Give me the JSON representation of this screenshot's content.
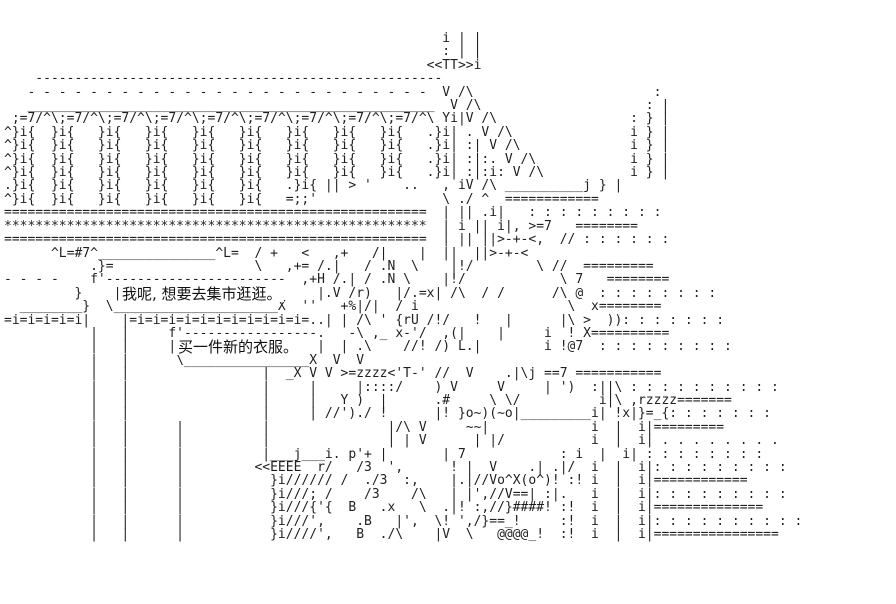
{
  "scene": {
    "background_color": "#ffffff",
    "ink_color": "#1f1f1f",
    "dialogue": {
      "line1": "我呢, 想要去集市逛逛。",
      "line2": "买一件新的衣服。"
    },
    "background_glyphs": [
      "《苶》i",
      "《竺竺",
      "宊宊",
      "雷雷"
    ],
    "art_lines": [
      "                                                        i | |",
      "                                                        : | |",
      "                                                      <<TT>>i",
      "    ----------------------------------------------------",
      "   - - - - - - - - - - - - - - - - - - - - - - - - - -  V /\\                       :",
      "   ____________________________________________________  V /\\                     : |",
      " ;=7/^\\;=7/^\\;=7/^\\;=7/^\\;=7/^\\;=7/^\\;=7/^\\;=7/^\\;=7/^\\ Yi|V /\\                 : } |",
      "^}i{  }i{   }i{   }i{   }i{   }i{   }i{   }i{   }i{   .}i| . V /\\               i } |",
      "^}i{  }i{   }i{   }i{   }i{   }i{   }i{   }i{   }i{   .}i| :| V /\\              i } |",
      "^}i{  }i{   }i{   }i{   }i{   }i{   }i{   }i{   }i{   .}i| :|:. V /\\            i } |",
      "^}i{  }i{   }i{   }i{   }i{   }i{   }i{   }i{   }i{   .}i| :|:i: V /\\           i } |",
      ".}i{  }i{   }i{   }i{   }i{   }i{   .}i{ || > '    ..   , iV /\\ __________j } |",
      "^}i{  }i{   }i{   }i{   }i{   }i{   =;;'                \\ ./ ^  ============",
      "======================================================  | || .i|   : : : : : : : : :",
      "******************************************************  | i || i|, >=7   ========",
      "======================================================  | || ||>-+-<,  // : : : : : :",
      "      ^L=#7^_______________^L=  / +   <   ,+   /|    |  ||  ||>-+-<",
      "           .}=                  \\   ,+= /.|   / .N  \\    |!/        \\ //  =========",
      "- - - -    f'-----------------------  ,+H /.| / .N \\    |!/            \\ 7   ========",
      "         }    |                         |.V /r)   |/.=x| /\\  / /      /\\ @  : : : : : : : :",
      "  ________}  \\_____________________X  ''   +%|/|  / i                   \\  x========",
      "=i=i=i=i=i|    |=i=i=i=i=i=i=i=i=i=i=i=..| | /\\ ' {rU /!/   !   |      |\\ >  )): : : : : : :",
      "           |   |     f'-----------------.   -\\ ,_ x-'/  ,(|    |     i  ! X==========",
      "           |   |     |                  |  | .\\    //! /) L.|        i !@7  : : : : : : : : :",
      "           |   |      \\________________X  V  V",
      "           |   |                 |  _X V V >=zzzz<'T-' //  V    .|\\j ==7 ===========",
      "           |   |                 |     |     |::::/    ) V     V     | ')  :||\\ : : : : : : : : : :",
      "           |   |                 |     |   Y )  |      .#     \\ \\/          i|\\ ,rzzzz=======",
      "           |   |                 |     | //')./ !      |! }o~)(~o|_________i| !x|}=_{: : : : : : :",
      "           |   |      |          |               |/\\ V     ~~|             i  |  i|=========",
      "           |   |      |          |               | | V      | |/           i  |  i| . . . . . . . .",
      "           |   |      |          |___j___i. p'+ |       | 7            : i  |  i| : : : : : : : :",
      "           |   |      |         <<EEEE  r/   /3  ',      ! |  V    .| .|/  i  |  i|: : : : : : : : :",
      "           |   |      |           }i////// /  ./3  :,    |.|//Vo^X(o^)! :! i  |  i|============",
      "           |   |      |           }i///; /    /3    /\\   | |',//V==| :|.   i  |  i|: : : : : : : : :",
      "           |   |      |           }i///{'{  B   .x   \\  .|! :,//}####! :!  i  |  i|==============",
      "           |   |      |           }i///',    .B   |',  \\! ',/}==_!     :!  i  |  i|: : : : : : : : : :",
      "           |   |      |           }i////',   B  ./\\    |V  \\   @@@@_!  :!  i  |  i|================"
    ]
  }
}
